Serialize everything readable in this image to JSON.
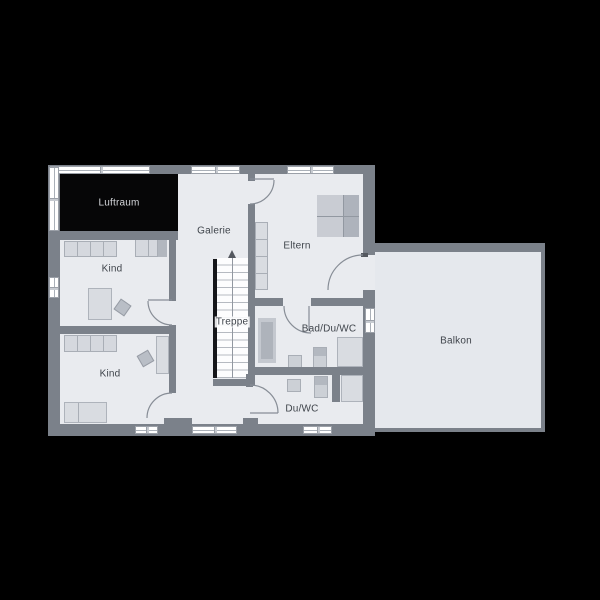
{
  "type": "floor-plan",
  "language": "de",
  "rooms": [
    {
      "id": "luftraum",
      "label": "Luftraum"
    },
    {
      "id": "galerie",
      "label": "Galerie"
    },
    {
      "id": "eltern",
      "label": "Eltern"
    },
    {
      "id": "kind-oben",
      "label": "Kind"
    },
    {
      "id": "kind-unten",
      "label": "Kind"
    },
    {
      "id": "treppe",
      "label": "Treppe"
    },
    {
      "id": "bad-du-wc",
      "label": "Bad/Du/WC"
    },
    {
      "id": "du-wc",
      "label": "Du/WC"
    },
    {
      "id": "balkon",
      "label": "Balkon"
    }
  ],
  "colors": {
    "background": "#000000",
    "wall": "#7b818a",
    "floor": "#e9ebef",
    "balcony_floor": "#e5e8ed",
    "void_fill": "#060607",
    "furniture_light": "#d6d9df",
    "furniture_dark": "#b2b7bf",
    "window": "#ffffff",
    "label_text": "#3f444b",
    "void_label_text": "#d4d6da"
  }
}
